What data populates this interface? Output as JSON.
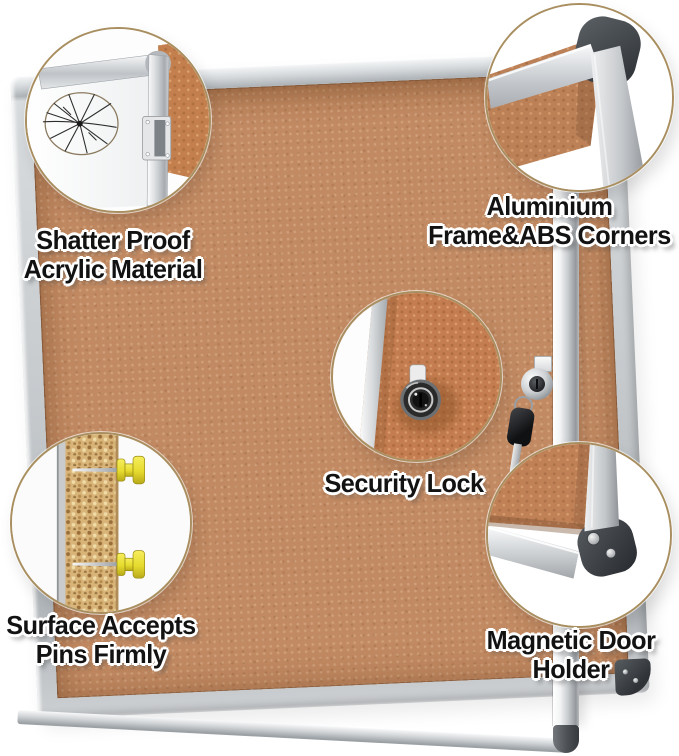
{
  "image_title": "Enclosed cork bulletin board feature callouts",
  "colors": {
    "background": "#ffffff",
    "cork": "#c28a62",
    "cork_grain": "#d8b478",
    "frame_silver": "#cdd0d3",
    "abs_corner_dark": "#3f4449",
    "callout_ring": "#a98f60",
    "pin_yellow": "#ece23c",
    "key_black": "#141517",
    "label_text": "#121212",
    "label_outline": "#ffffff"
  },
  "callouts": {
    "shatter": {
      "line1": "Shatter Proof",
      "line2": "Acrylic Material"
    },
    "frame": {
      "line1": "Aluminium",
      "line2": "Frame&ABS Corners"
    },
    "lock": {
      "line1": "Security Lock"
    },
    "pins": {
      "line1": "Surface Accepts",
      "line2": "Pins Firmly"
    },
    "magnet": {
      "line1": "Magnetic Door",
      "line2": "Holder"
    }
  }
}
